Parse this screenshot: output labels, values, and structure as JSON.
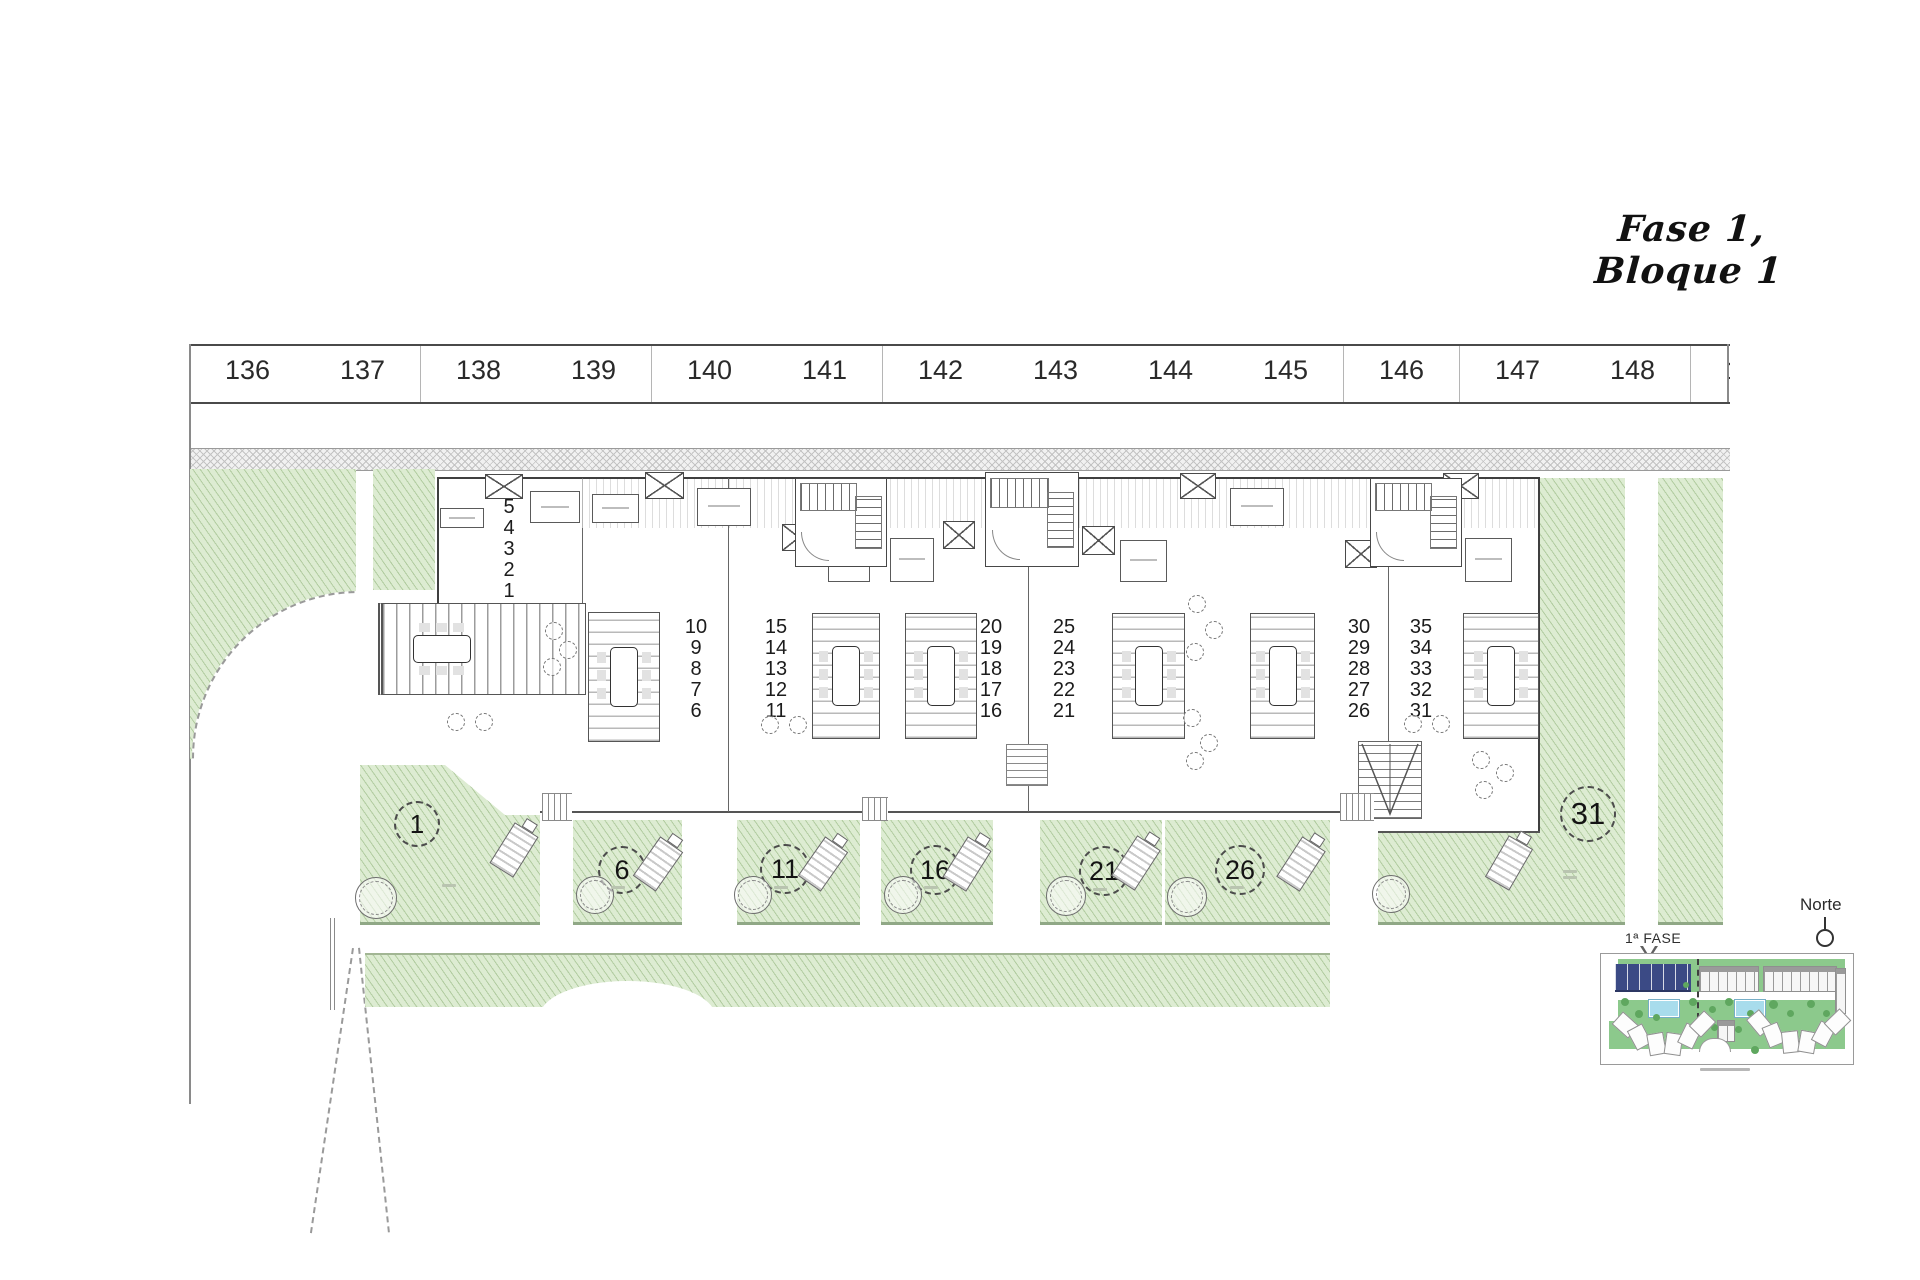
{
  "title": "Fase 1, Bloque 1",
  "parking": {
    "numbers": [
      "136",
      "137",
      "138",
      "139",
      "140",
      "141",
      "142",
      "143",
      "144",
      "145",
      "146",
      "147",
      "148",
      "149"
    ]
  },
  "building": {
    "unit_stacks": [
      {
        "numbers": [
          "5",
          "4",
          "3",
          "2",
          "1"
        ]
      },
      {
        "numbers": [
          "10",
          "9",
          "8",
          "7",
          "6"
        ]
      },
      {
        "numbers": [
          "15",
          "14",
          "13",
          "12",
          "11"
        ]
      },
      {
        "numbers": [
          "20",
          "19",
          "18",
          "17",
          "16"
        ]
      },
      {
        "numbers": [
          "25",
          "24",
          "23",
          "22",
          "21"
        ]
      },
      {
        "numbers": [
          "30",
          "29",
          "28",
          "27",
          "26"
        ]
      },
      {
        "numbers": [
          "35",
          "34",
          "33",
          "32",
          "31"
        ]
      }
    ]
  },
  "gardens": {
    "plot_labels": [
      "1",
      "6",
      "11",
      "16",
      "21",
      "26",
      "31"
    ]
  },
  "minimap": {
    "phase_label": "1ª FASE",
    "north_label": "Norte"
  },
  "colors": {
    "garden_green": "#ddecd2",
    "garden_hatch": "#7da564",
    "garden_edge": "#90a886",
    "map_lawn": "#8cc98c",
    "map_tree": "#5fa75f",
    "map_pool": "#a8dcec",
    "phase_blue": "#3b4a85",
    "line_dark": "#3f3f3f"
  }
}
